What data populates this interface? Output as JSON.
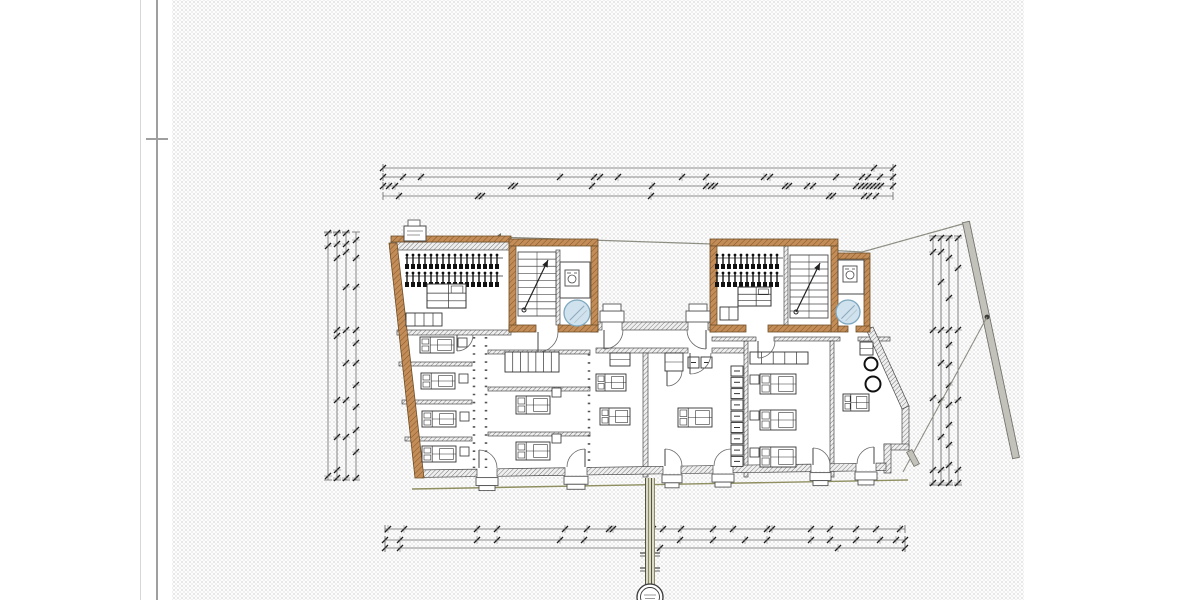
{
  "palette": {
    "paper_dot": "#e1e1e1",
    "line": "#3f3f3f",
    "dim_line": "#6a6a6a",
    "tick": "#1f1f1f",
    "masonry_fill": "#c48c57",
    "masonry_edge": "#6f4f28",
    "wall_fill": "#efefef",
    "hatch_line": "#5f5f5f",
    "glass_fill": "#cfe2ee",
    "glass_edge": "#7fa8bf",
    "boundary": "#8f8f85",
    "boundary_bar_fill": "#c2c2ba",
    "terrain": "#8f8f62",
    "bundle_fill": "#d9d9c5",
    "furniture_line": "#333333"
  },
  "margin": {
    "thin_x": 140,
    "thick_x": 156,
    "tick_x": 146,
    "tick_y": 138,
    "tick_w": 22
  },
  "paper": {
    "x": 172,
    "w": 852
  },
  "dimensions": {
    "top": {
      "x1": 383,
      "x2": 893,
      "lines": [
        {
          "y": 168,
          "ticks": [
            383,
            874,
            893
          ]
        },
        {
          "y": 177,
          "ticks": [
            383,
            403,
            421,
            560,
            594,
            600,
            618,
            682,
            706,
            764,
            770,
            836,
            862,
            868,
            880,
            893
          ]
        },
        {
          "y": 186,
          "ticks": [
            383,
            389,
            395,
            511,
            515,
            592,
            652,
            706,
            711,
            715,
            785,
            789,
            807,
            813,
            856,
            861,
            865,
            869,
            873,
            877,
            881,
            893
          ]
        },
        {
          "y": 196,
          "ticks": [
            399,
            478,
            482,
            651,
            829,
            833,
            864,
            869,
            876
          ]
        }
      ]
    },
    "bottom": {
      "x1": 385,
      "x2": 905,
      "lines": [
        {
          "y": 529,
          "ticks": [
            388,
            404,
            477,
            497,
            565,
            587,
            609,
            613,
            649,
            653,
            663,
            681,
            713,
            733,
            767,
            772,
            811,
            830,
            856,
            876,
            900
          ]
        },
        {
          "y": 540,
          "ticks": [
            385,
            400,
            477,
            497,
            560,
            584,
            648,
            680,
            713,
            745,
            767,
            811,
            830,
            856,
            880,
            896,
            905
          ]
        },
        {
          "y": 548,
          "ticks": [
            385,
            400,
            660,
            838,
            905
          ]
        }
      ]
    },
    "left": {
      "y1": 232,
      "y2": 480,
      "lines": [
        {
          "x": 328,
          "ticks": [
            233,
            246,
            476
          ]
        },
        {
          "x": 337,
          "ticks": [
            233,
            244,
            258,
            330,
            336,
            400,
            437,
            470,
            478
          ]
        },
        {
          "x": 346,
          "ticks": [
            233,
            244,
            252,
            287,
            330,
            363,
            400,
            437,
            478
          ]
        },
        {
          "x": 356,
          "ticks": [
            240,
            258,
            287,
            330,
            343,
            363,
            385,
            407,
            430,
            452,
            478
          ]
        }
      ]
    },
    "right": {
      "y1": 236,
      "y2": 485,
      "lines": [
        {
          "x": 933,
          "ticks": [
            238,
            252,
            330,
            398,
            470,
            483
          ]
        },
        {
          "x": 941,
          "ticks": [
            238,
            252,
            282,
            330,
            363,
            400,
            437,
            470,
            483
          ]
        },
        {
          "x": 949,
          "ticks": [
            238,
            258,
            298,
            330,
            345,
            365,
            385,
            405,
            425,
            445,
            465,
            483
          ]
        },
        {
          "x": 958,
          "ticks": [
            238,
            268,
            330,
            400,
            470,
            483
          ]
        }
      ]
    }
  },
  "boundary": {
    "polyline": [
      [
        497,
        237
      ],
      [
        712,
        244
      ],
      [
        862,
        252
      ],
      [
        966,
        223
      ]
    ],
    "bar": {
      "x1": 966,
      "y1": 222,
      "x2": 1016,
      "y2": 458,
      "width": 7
    },
    "dot": [
      987,
      317
    ],
    "branch": [
      [
        987,
        317
      ],
      [
        903,
        472
      ]
    ],
    "gate": {
      "cx": 913,
      "cy": 458,
      "w": 16,
      "h": 6,
      "angle": 62
    }
  },
  "terrain": [
    [
      412,
      489
    ],
    [
      908,
      480
    ]
  ],
  "building": {
    "outline": [
      [
        389,
        243
      ],
      [
        511,
        243
      ],
      [
        511,
        239
      ],
      [
        598,
        239
      ],
      [
        598,
        322
      ],
      [
        712,
        322
      ],
      [
        712,
        239
      ],
      [
        838,
        239
      ],
      [
        838,
        253
      ],
      [
        870,
        253
      ],
      [
        870,
        331
      ],
      [
        905,
        408
      ],
      [
        905,
        446
      ],
      [
        888,
        450
      ],
      [
        888,
        470
      ],
      [
        416,
        478
      ]
    ],
    "masonry_polys": [
      [
        [
          389,
          243
        ],
        [
          397,
          243
        ],
        [
          424,
          478
        ],
        [
          415,
          478
        ]
      ]
    ],
    "masonry_rects": [
      [
        391,
        236,
        120,
        6
      ],
      [
        509,
        239,
        89,
        7
      ],
      [
        509,
        246,
        7,
        86
      ],
      [
        591,
        246,
        7,
        86
      ],
      [
        509,
        325,
        27,
        7
      ],
      [
        558,
        325,
        40,
        7
      ],
      [
        710,
        239,
        128,
        7
      ],
      [
        710,
        246,
        7,
        86
      ],
      [
        831,
        246,
        7,
        86
      ],
      [
        710,
        325,
        36,
        7
      ],
      [
        768,
        325,
        63,
        7
      ],
      [
        838,
        253,
        32,
        6
      ],
      [
        864,
        259,
        6,
        73
      ],
      [
        838,
        326,
        10,
        6
      ],
      [
        856,
        326,
        14,
        6
      ]
    ],
    "gray_rects": [
      [
        391,
        242,
        120,
        8
      ],
      [
        397,
        330,
        114,
        5
      ],
      [
        598,
        322,
        4,
        8
      ],
      [
        622,
        322,
        66,
        8
      ],
      [
        708,
        322,
        4,
        8
      ],
      [
        596,
        348,
        92,
        5
      ],
      [
        712,
        348,
        33,
        5
      ],
      [
        643,
        353,
        5,
        124
      ],
      [
        744,
        341,
        4,
        136
      ],
      [
        712,
        337,
        44,
        4
      ],
      [
        774,
        337,
        66,
        4
      ],
      [
        858,
        337,
        32,
        4
      ],
      [
        830,
        341,
        4,
        136
      ],
      [
        399,
        362,
        73,
        4
      ],
      [
        402,
        400,
        70,
        4
      ],
      [
        405,
        437,
        67,
        4
      ],
      [
        488,
        350,
        102,
        4
      ],
      [
        488,
        387,
        102,
        4
      ],
      [
        488,
        432,
        102,
        4
      ],
      [
        902,
        406,
        7,
        42
      ],
      [
        884,
        444,
        25,
        6
      ],
      [
        884,
        444,
        7,
        29
      ],
      [
        556,
        250,
        4,
        75
      ],
      [
        784,
        246,
        4,
        79
      ]
    ],
    "gray_polys": [
      [
        [
          866,
          329
        ],
        [
          873,
          327
        ],
        [
          909,
          406
        ],
        [
          902,
          409
        ]
      ]
    ],
    "bottom_wall": {
      "x0": 416,
      "x1": 886,
      "y_top0": 470,
      "y_top1": 463,
      "thick": 7.5,
      "gaps": [
        [
          477,
          497
        ],
        [
          565,
          587
        ],
        [
          663,
          681
        ],
        [
          713,
          733
        ],
        [
          811,
          830
        ],
        [
          856,
          876
        ]
      ]
    },
    "dotted_partitions": [
      [
        474,
        337,
        474,
        468
      ],
      [
        486,
        337,
        486,
        468
      ],
      [
        589,
        354,
        589,
        468
      ]
    ],
    "thin_rooms": [
      [
        560,
        262,
        30,
        36
      ],
      [
        838,
        260,
        26,
        34
      ]
    ]
  },
  "stairs": [
    {
      "x": 518,
      "y": 252,
      "w": 38,
      "h": 64,
      "treads": 9
    },
    {
      "x": 790,
      "y": 255,
      "w": 38,
      "h": 63,
      "treads": 9
    }
  ],
  "elevators": [
    {
      "cx": 577,
      "cy": 313,
      "r": 13
    },
    {
      "cx": 848,
      "cy": 312,
      "r": 12
    }
  ],
  "washer_icons": [
    [
      565,
      270
    ],
    [
      843,
      266
    ]
  ],
  "furniture": {
    "hanger_rows": [
      {
        "x": 407,
        "y": 255,
        "count": 16,
        "dx": 6
      },
      {
        "x": 407,
        "y": 273,
        "count": 16,
        "dx": 6
      },
      {
        "x": 717,
        "y": 255,
        "count": 11,
        "dx": 6
      },
      {
        "x": 717,
        "y": 273,
        "count": 11,
        "dx": 6
      }
    ],
    "beds": [
      {
        "x": 420,
        "y": 337,
        "w": 34,
        "h": 16
      },
      {
        "x": 421,
        "y": 373,
        "w": 34,
        "h": 16
      },
      {
        "x": 422,
        "y": 411,
        "w": 34,
        "h": 16
      },
      {
        "x": 422,
        "y": 446,
        "w": 34,
        "h": 16
      },
      {
        "x": 516,
        "y": 396,
        "w": 34,
        "h": 18
      },
      {
        "x": 516,
        "y": 442,
        "w": 34,
        "h": 18
      },
      {
        "x": 596,
        "y": 374,
        "w": 30,
        "h": 17
      },
      {
        "x": 600,
        "y": 408,
        "w": 30,
        "h": 17
      },
      {
        "x": 678,
        "y": 408,
        "w": 34,
        "h": 19
      },
      {
        "x": 760,
        "y": 374,
        "w": 36,
        "h": 20
      },
      {
        "x": 760,
        "y": 410,
        "w": 36,
        "h": 20
      },
      {
        "x": 760,
        "y": 447,
        "w": 36,
        "h": 20
      },
      {
        "x": 843,
        "y": 394,
        "w": 26,
        "h": 17
      }
    ],
    "nightstands": [
      [
        458,
        338
      ],
      [
        459,
        374
      ],
      [
        460,
        412
      ],
      [
        460,
        447
      ],
      [
        552,
        388
      ],
      [
        552,
        434
      ],
      [
        750,
        375
      ],
      [
        750,
        411
      ],
      [
        750,
        448
      ]
    ],
    "shelf_units": [
      {
        "x": 505,
        "y": 352,
        "w": 54,
        "h": 20,
        "dividers": 6
      },
      {
        "x": 750,
        "y": 352,
        "w": 58,
        "h": 12,
        "dividers": 4
      }
    ],
    "cabinets": [
      {
        "x": 610,
        "y": 353,
        "w": 20,
        "h": 13
      },
      {
        "x": 665,
        "y": 353,
        "w": 18,
        "h": 18
      },
      {
        "x": 860,
        "y": 342,
        "w": 13,
        "h": 13
      }
    ],
    "fixture_squares": [
      [
        688,
        357
      ],
      [
        701,
        357
      ]
    ],
    "lockers": {
      "x": 731,
      "y0": 366,
      "w": 12,
      "h": 10,
      "count": 9,
      "step": 11.3
    },
    "round_tables": [
      {
        "cx": 871,
        "cy": 364,
        "r": 6.5
      },
      {
        "cx": 873,
        "cy": 384,
        "r": 7.5
      }
    ],
    "benches": [
      {
        "x": 406,
        "y": 313,
        "w": 36,
        "h": 13,
        "dividers": 3
      },
      {
        "x": 720,
        "y": 307,
        "w": 18,
        "h": 13,
        "dividers": 1
      }
    ],
    "desks": [
      {
        "x": 427,
        "y": 284,
        "w": 39,
        "h": 24
      },
      {
        "x": 738,
        "y": 287,
        "w": 33,
        "h": 19
      }
    ],
    "legend_box": {
      "x": 404,
      "y": 226,
      "w": 22,
      "h": 15
    }
  },
  "doors": [
    {
      "px": 479,
      "py": 468,
      "r": 18,
      "a0": -90,
      "a1": 0
    },
    {
      "px": 585,
      "py": 467,
      "r": 18,
      "a0": -90,
      "a1": -180
    },
    {
      "px": 665,
      "py": 466,
      "r": 17,
      "a0": -90,
      "a1": 0
    },
    {
      "px": 731,
      "py": 466,
      "r": 17,
      "a0": -90,
      "a1": -180
    },
    {
      "px": 813,
      "py": 465,
      "r": 17,
      "a0": -90,
      "a1": 0
    },
    {
      "px": 874,
      "py": 464,
      "r": 17,
      "a0": -90,
      "a1": -180
    },
    {
      "px": 604,
      "py": 330,
      "r": 19,
      "a0": 90,
      "a1": 0
    },
    {
      "px": 706,
      "py": 330,
      "r": 19,
      "a0": 90,
      "a1": 180
    },
    {
      "px": 538,
      "py": 332,
      "r": 20,
      "a0": 90,
      "a1": 0
    },
    {
      "px": 457,
      "py": 335,
      "r": 16,
      "a0": 90,
      "a1": 0
    },
    {
      "px": 690,
      "py": 353,
      "r": 21,
      "a0": 90,
      "a1": 0
    },
    {
      "px": 758,
      "py": 341,
      "r": 17,
      "a0": 90,
      "a1": 0
    },
    {
      "px": 667,
      "py": 371,
      "r": 15,
      "a0": 90,
      "a1": 0
    }
  ],
  "sills_top": [
    {
      "x": 600,
      "w": 24
    },
    {
      "x": 686,
      "w": 24
    }
  ],
  "section_marker": {
    "x": 650,
    "top": 478,
    "bottom": 585,
    "tick_ys": [
      553,
      568
    ],
    "circle_cy": 597,
    "r_outer": 13,
    "r_inner": 9.5
  }
}
